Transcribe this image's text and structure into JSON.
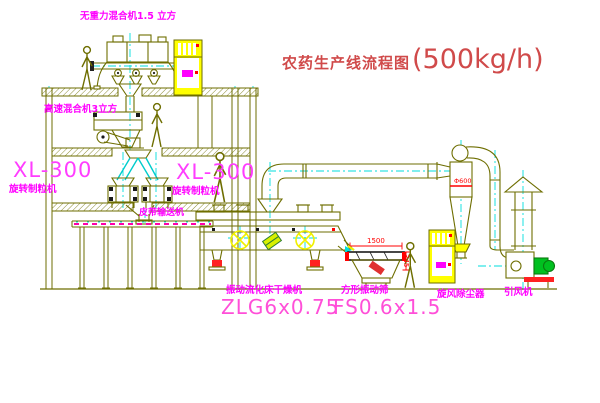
{
  "title": {
    "name": "农药生产线流程图",
    "capacity": "(500kg/h)"
  },
  "equipment": {
    "gravity_mixer": {
      "label": "无重力混合机1.5 立方"
    },
    "high_speed_mixer": {
      "label": "高速混合机3立方"
    },
    "granulator_left": {
      "model": "XL-300",
      "name": "旋转制粒机"
    },
    "granulator_right": {
      "model": "XL-300",
      "name": "旋转制粒机"
    },
    "belt_conveyor": {
      "label": "皮带输送机"
    },
    "fluid_bed_dryer": {
      "name": "振动流化床干燥机",
      "model": "ZLG6x0.75"
    },
    "square_sieve": {
      "name": "方形振动筛",
      "model": "FS0.6x1.5",
      "dim_width": "1500",
      "dim_height": "345"
    },
    "cyclone": {
      "label": "旋风除尘器",
      "mark": "Φ600"
    },
    "induced_draft_fan": {
      "label": "引风机"
    }
  },
  "colors": {
    "line_olive": "#6e6e00",
    "centerline_cyan": "#00dddd",
    "label_magenta": "#ff00ff",
    "model_pink": "#ff4fd8",
    "title_red": "#d04a4a",
    "dimension_red": "#ff0000",
    "cabinet_yellow": "#ffff00",
    "motor_green": "#00c020",
    "damper_red": "#ff2222"
  }
}
